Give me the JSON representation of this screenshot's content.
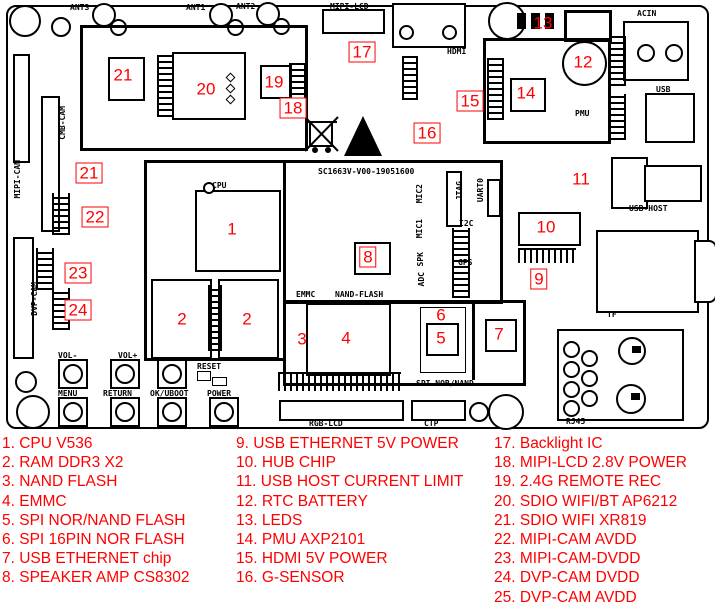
{
  "colors": {
    "line": "#000000",
    "marker_red": "#ff0000",
    "legend_red": "#ff0000",
    "background": "#ffffff"
  },
  "legend": {
    "columns": [
      {
        "items": [
          "1. CPU V536",
          "2. RAM DDR3 X2",
          "3. NAND FLASH",
          "4. EMMC",
          "5. SPI NOR/NAND FLASH",
          "6. SPI 16PIN NOR FLASH",
          "7. USB ETHERNET chip",
          "8. SPEAKER AMP CS8302"
        ]
      },
      {
        "items": [
          "9. USB ETHERNET 5V POWER",
          "10. HUB CHIP",
          "11. USB HOST CURRENT LIMIT",
          "12. RTC BATTERY",
          "13. LEDS",
          "14. PMU AXP2101",
          "15. HDMI 5V POWER",
          "16. G-SENSOR"
        ]
      },
      {
        "items": [
          "17. Backlight IC",
          "18. MIPI-LCD 2.8V POWER",
          "19. 2.4G REMOTE REC",
          "20. SDIO WIFI/BT AP6212",
          "21. SDIO WIFI XR819",
          "22. MIPI-CAM AVDD",
          "23. MIPI-CAM-DVDD",
          "24. DVP-CAM DVDD",
          "25. DVP-CAM AVDD"
        ]
      }
    ]
  },
  "board": {
    "silkscreen_code": "SC1663V-V00-19051600",
    "labels": [
      {
        "text": "ANT3",
        "x": 70,
        "y": 3
      },
      {
        "text": "ANT1",
        "x": 186,
        "y": 3
      },
      {
        "text": "ANT2",
        "x": 236,
        "y": 2
      },
      {
        "text": "MIPI-LCD",
        "x": 330,
        "y": 2
      },
      {
        "text": "HDMI",
        "x": 447,
        "y": 47
      },
      {
        "text": "ACIN",
        "x": 637,
        "y": 9
      },
      {
        "text": "USB",
        "x": 656,
        "y": 85
      },
      {
        "text": "PMU",
        "x": 575,
        "y": 109
      },
      {
        "text": "USB-HOST",
        "x": 629,
        "y": 204
      },
      {
        "text": "TF",
        "x": 607,
        "y": 310
      },
      {
        "text": "RJ45",
        "x": 566,
        "y": 417
      },
      {
        "text": "RGB-LCD",
        "x": 309,
        "y": 419
      },
      {
        "text": "CTP",
        "x": 424,
        "y": 419
      },
      {
        "text": "SPI NOR/NAND",
        "x": 416,
        "y": 379
      },
      {
        "text": "EMMC",
        "x": 296,
        "y": 290
      },
      {
        "text": "NAND-FLASH",
        "x": 335,
        "y": 290
      },
      {
        "text": "CPU",
        "x": 212,
        "y": 181
      },
      {
        "text": "SC1663V-V00-19051600",
        "x": 318,
        "y": 167
      },
      {
        "text": "I2C",
        "x": 459,
        "y": 219
      },
      {
        "text": "GPS",
        "x": 458,
        "y": 258
      },
      {
        "text": "VOL-",
        "x": 58,
        "y": 351
      },
      {
        "text": "VOL+",
        "x": 118,
        "y": 351
      },
      {
        "text": "RESET",
        "x": 197,
        "y": 362
      },
      {
        "text": "MENU",
        "x": 58,
        "y": 389
      },
      {
        "text": "RETURN",
        "x": 103,
        "y": 389
      },
      {
        "text": "OK/UBOOT",
        "x": 150,
        "y": 389
      },
      {
        "text": "POWER",
        "x": 207,
        "y": 389
      },
      {
        "text": "JTAG",
        "x": 455,
        "y": 181,
        "vert": true
      },
      {
        "text": "UART0",
        "x": 476,
        "y": 178,
        "vert": true
      },
      {
        "text": "MIC2",
        "x": 415,
        "y": 184,
        "vert": true
      },
      {
        "text": "MIC1",
        "x": 415,
        "y": 219,
        "vert": true
      },
      {
        "text": "SPK",
        "x": 416,
        "y": 252,
        "vert": true
      },
      {
        "text": "ADC",
        "x": 417,
        "y": 272,
        "vert": true
      },
      {
        "text": "CMB-CAM",
        "x": 58,
        "y": 106,
        "vert": true
      },
      {
        "text": "MIPI-CAM",
        "x": 13,
        "y": 160,
        "vert": true
      },
      {
        "text": "DVP-CAM",
        "x": 30,
        "y": 282,
        "vert": true
      }
    ],
    "markers": [
      {
        "n": "1",
        "x": 232,
        "y": 229
      },
      {
        "n": "2",
        "x": 182,
        "y": 319
      },
      {
        "n": "2",
        "x": 247,
        "y": 319
      },
      {
        "n": "3",
        "x": 302,
        "y": 339
      },
      {
        "n": "4",
        "x": 346,
        "y": 338
      },
      {
        "n": "5",
        "x": 441,
        "y": 338
      },
      {
        "n": "6",
        "x": 441,
        "y": 315
      },
      {
        "n": "7",
        "x": 499,
        "y": 334
      },
      {
        "n": "8",
        "x": 368,
        "y": 257,
        "boxed": true
      },
      {
        "n": "9",
        "x": 539,
        "y": 279,
        "boxed": true
      },
      {
        "n": "10",
        "x": 546,
        "y": 227
      },
      {
        "n": "11",
        "x": 581,
        "y": 179
      },
      {
        "n": "12",
        "x": 583,
        "y": 62
      },
      {
        "n": "13",
        "x": 543,
        "y": 23
      },
      {
        "n": "14",
        "x": 526,
        "y": 93
      },
      {
        "n": "15",
        "x": 470,
        "y": 101,
        "boxed": true
      },
      {
        "n": "16",
        "x": 427,
        "y": 133,
        "boxed": true
      },
      {
        "n": "17",
        "x": 362,
        "y": 52,
        "boxed": true
      },
      {
        "n": "18",
        "x": 293,
        "y": 108,
        "boxed": true
      },
      {
        "n": "19",
        "x": 274,
        "y": 82
      },
      {
        "n": "20",
        "x": 206,
        "y": 89
      },
      {
        "n": "21",
        "x": 123,
        "y": 75
      },
      {
        "n": "21",
        "x": 89,
        "y": 173,
        "boxed": true
      },
      {
        "n": "22",
        "x": 95,
        "y": 217,
        "boxed": true
      },
      {
        "n": "23",
        "x": 78,
        "y": 273,
        "boxed": true
      },
      {
        "n": "24",
        "x": 78,
        "y": 310,
        "boxed": true
      }
    ]
  }
}
